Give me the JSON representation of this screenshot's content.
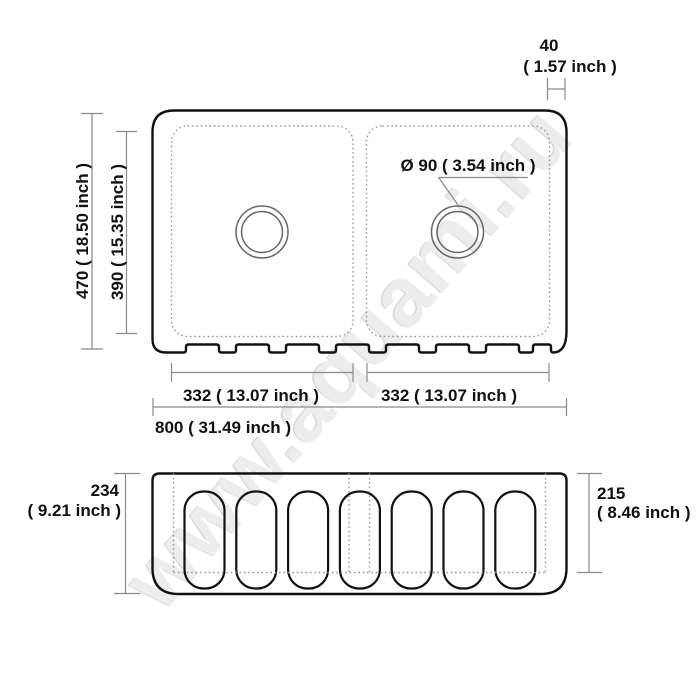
{
  "watermark": {
    "text": "www.aquami.ru"
  },
  "colors": {
    "background": "#ffffff",
    "outline": "#111111",
    "dimension_lines": "#8a8a8a",
    "dotted_lines": "#9a9a9a",
    "watermark": "#ededed"
  },
  "top_view": {
    "drain_label": "Ø 90 ( 3.54 inch )",
    "rim_width": {
      "value": "40",
      "inches": "( 1.57 inch )"
    },
    "overall_depth": "470 ( 18.50 inch )",
    "bowl_depth": "390 ( 15.35 inch )",
    "left_bowl_width": "332 ( 13.07 inch )",
    "right_bowl_width": "332 ( 13.07 inch )",
    "overall_width": "800 ( 31.49 inch )"
  },
  "front_view": {
    "apron_height": {
      "value": "234",
      "inches": "( 9.21 inch )"
    },
    "inner_height": {
      "value": "215",
      "inches": "( 8.46 inch )"
    },
    "flute_count": 7
  }
}
